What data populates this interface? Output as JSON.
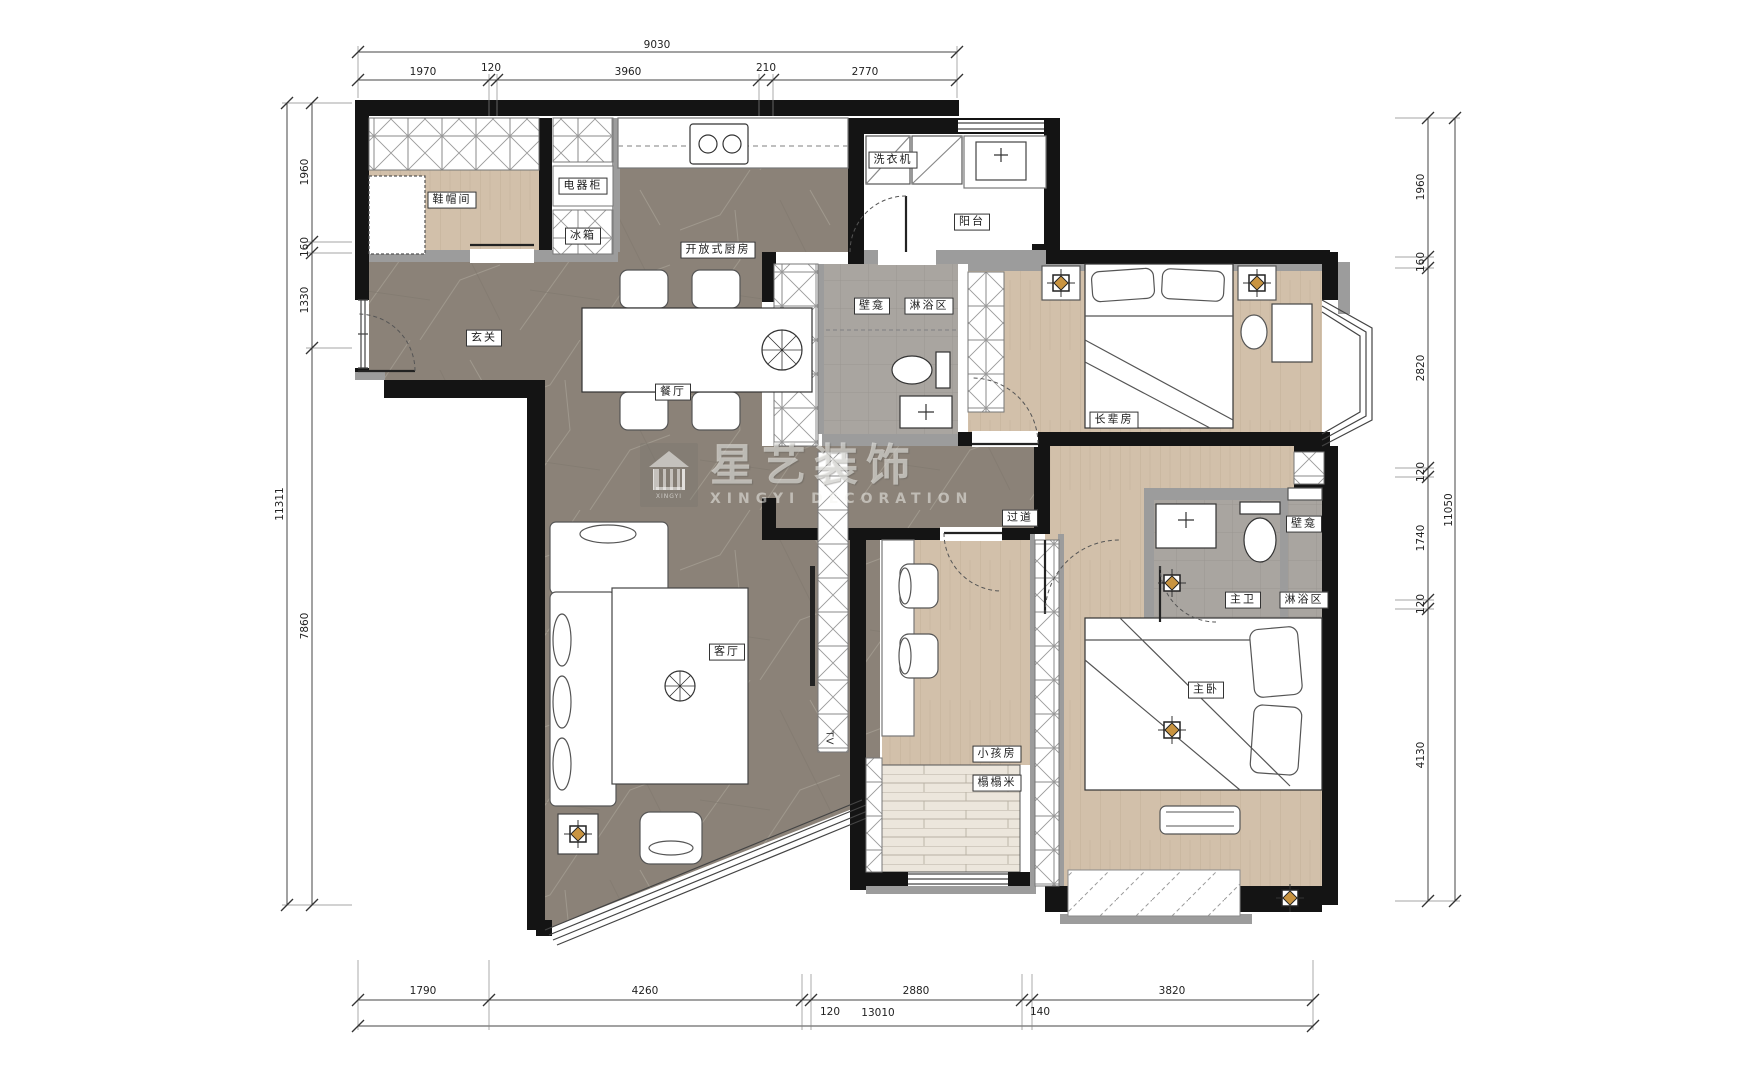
{
  "watermark": {
    "brand": "星艺装饰",
    "subtitle": "XINGYI DECORATION",
    "logo_caption": "XINGYI",
    "logo_icon": "house-icon"
  },
  "rooms": {
    "shoe_room": "鞋帽间",
    "appliance_cabinet": "电器柜",
    "fridge": "冰箱",
    "open_kitchen": "开放式厨房",
    "washing_machine": "洗衣机",
    "balcony": "阳台",
    "entry": "玄关",
    "dining": "餐厅",
    "niche_bath1": "壁龛",
    "shower_bath1": "淋浴区",
    "elder_room": "长辈房",
    "corridor": "过道",
    "master_bath": "主卫",
    "niche_bath2": "壁龛",
    "shower_bath2": "淋浴区",
    "living_room": "客厅",
    "kids_room": "小孩房",
    "tatami": "榻榻米",
    "master_bedroom": "主卧",
    "tv": "TV"
  },
  "dimensions": {
    "top": {
      "total": "9030",
      "segments": [
        "1970",
        "120",
        "3960",
        "210",
        "2770"
      ]
    },
    "left": {
      "total": "11311",
      "segments": [
        "1960",
        "160",
        "1330",
        "7860"
      ]
    },
    "right": {
      "total": "11050",
      "segments": [
        "1960",
        "160",
        "2820",
        "120",
        "1740",
        "120",
        "4130"
      ]
    },
    "bottom": {
      "total": "13010",
      "segments": [
        "1790",
        "4260",
        "120",
        "2880",
        "140",
        "3820"
      ]
    }
  },
  "colors": {
    "marble_floor": "#8b8278",
    "wood_floor": "#d2c0aa",
    "bath_tile": "#a9a5a0",
    "wall": "#141414",
    "half_wall": "#9c9c9c",
    "lamp_gold": "#c99440"
  }
}
